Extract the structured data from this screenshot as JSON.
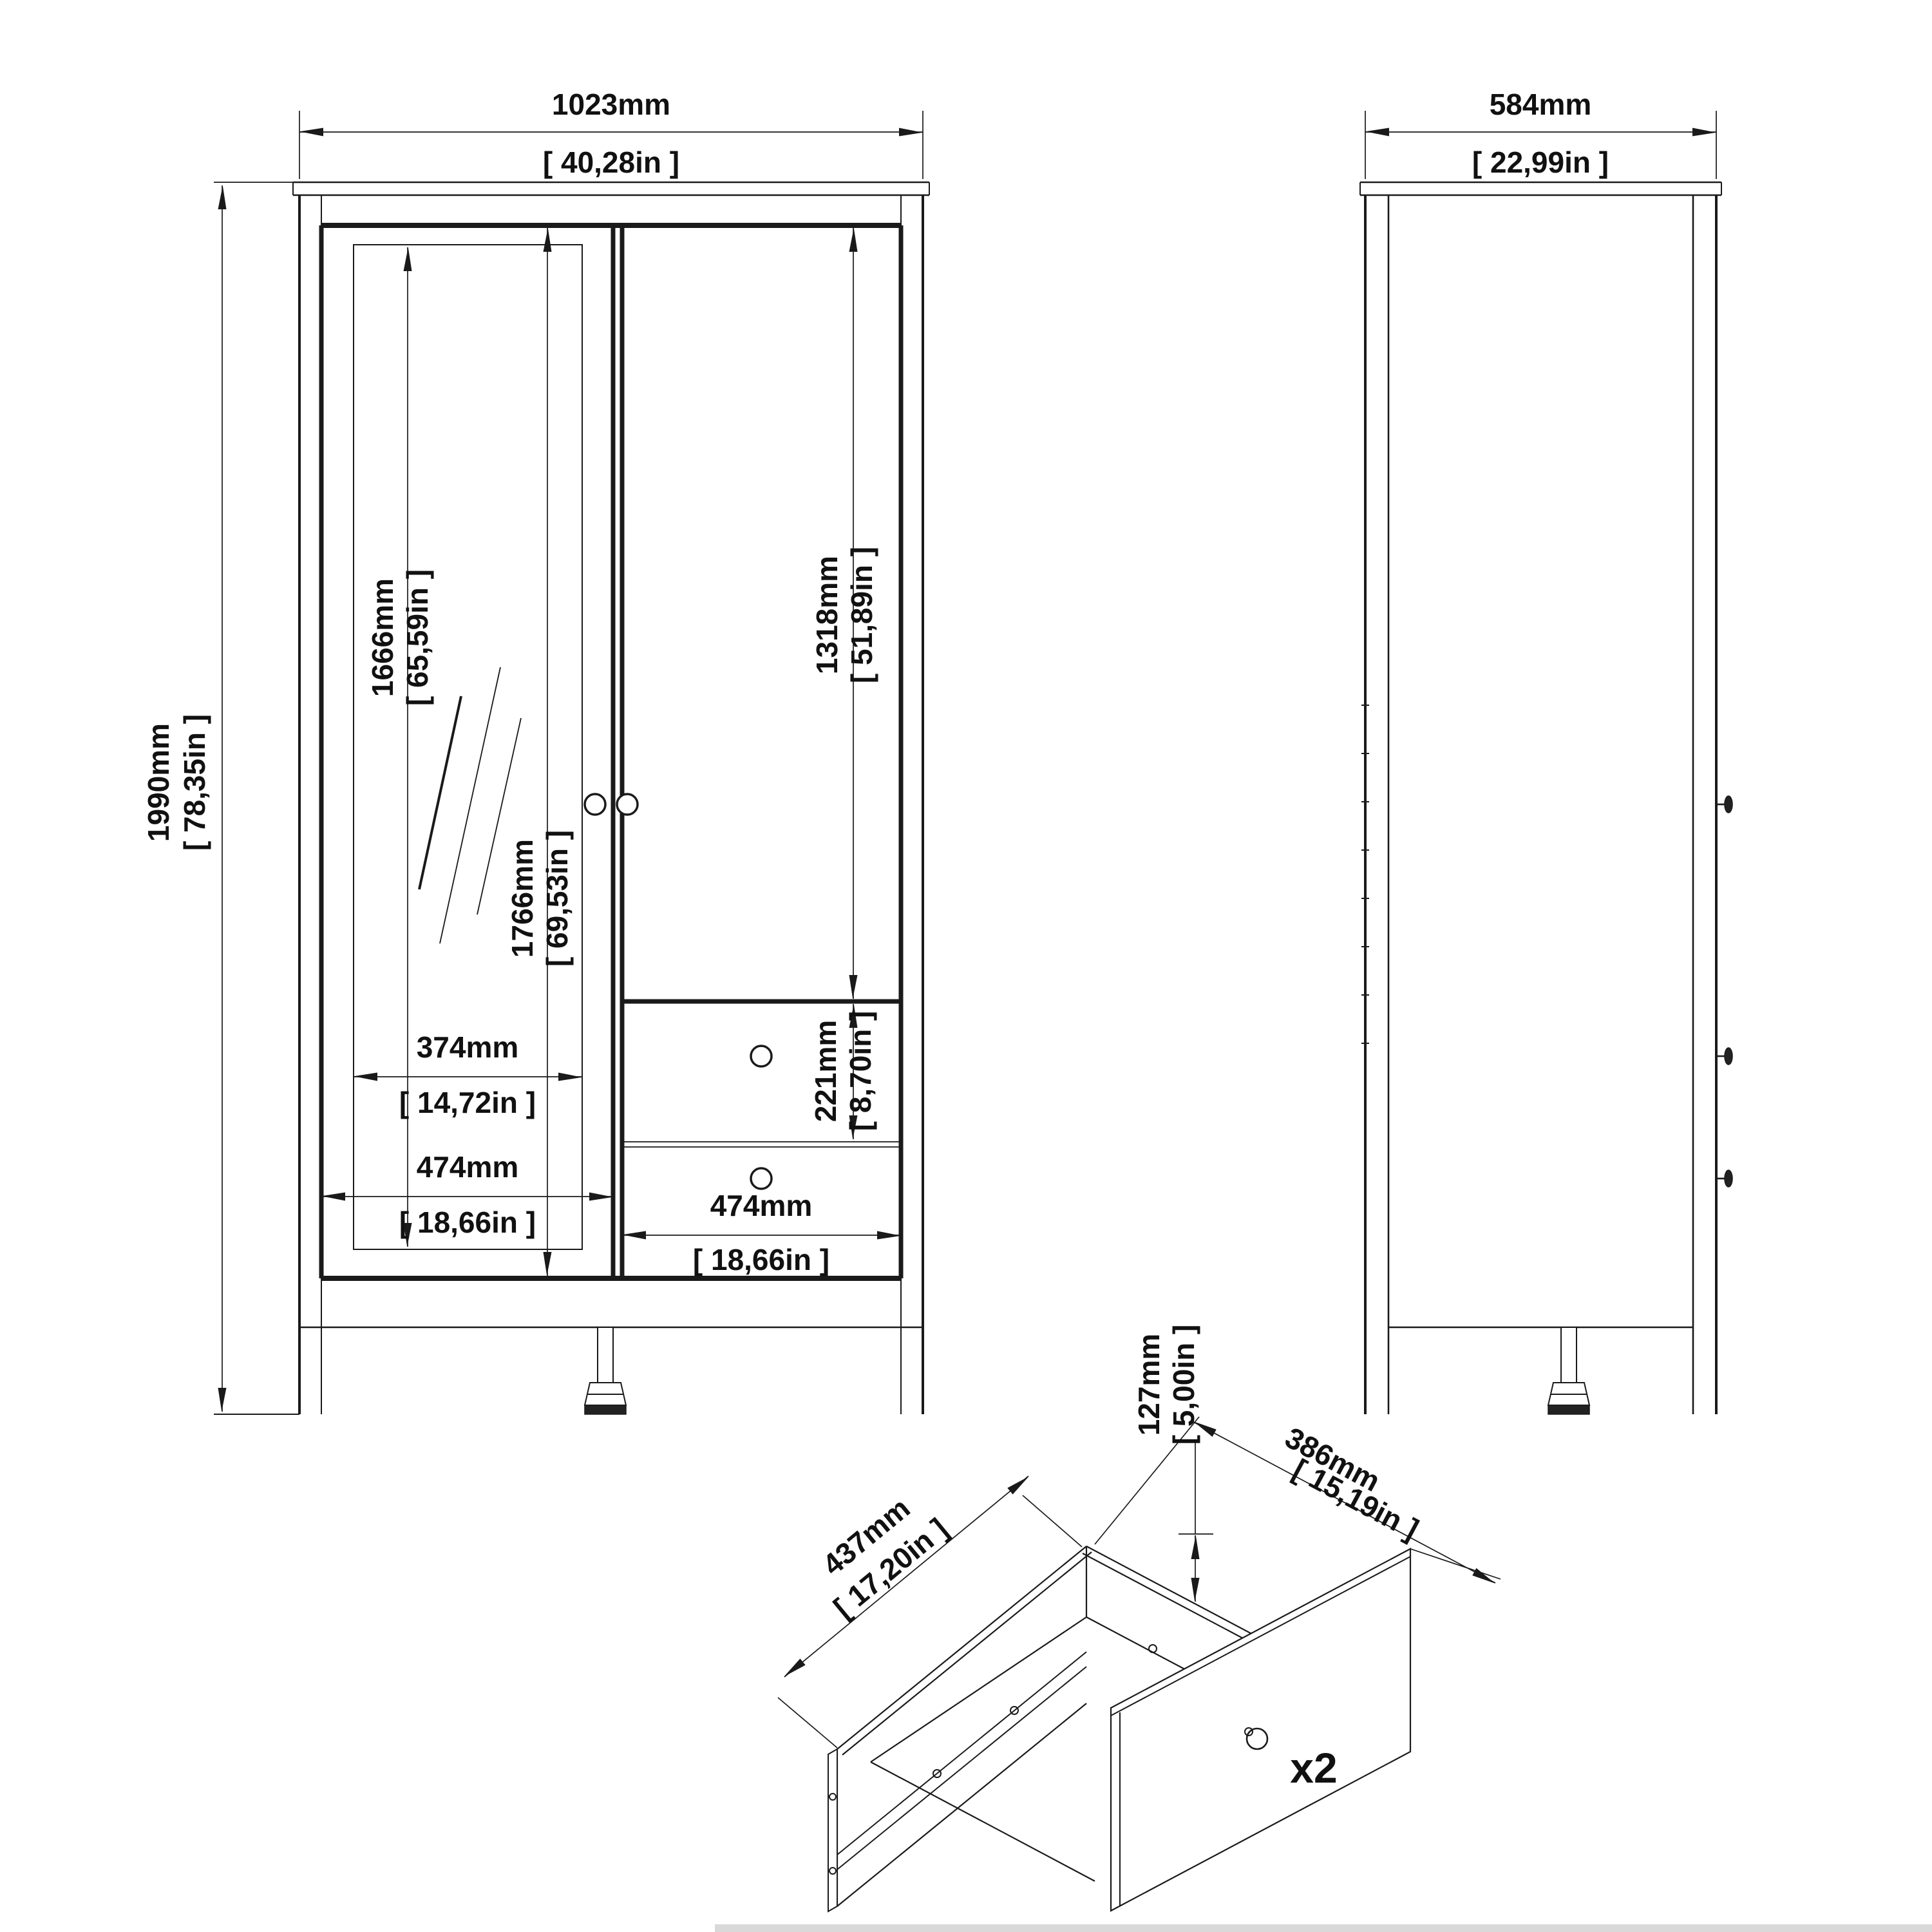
{
  "front_view": {
    "width": {
      "mm": "1023mm",
      "in": "[ 40,28in ]"
    },
    "height": {
      "mm": "1990mm",
      "in": "[ 78,35in ]"
    },
    "mirror_height": {
      "mm": "1666mm",
      "in": "[ 65,59in ]"
    },
    "door_height": {
      "mm": "1766mm",
      "in": "[ 69,53in ]"
    },
    "right_door_height": {
      "mm": "1318mm",
      "in": "[ 51,89in ]"
    },
    "drawer_height": {
      "mm": "221mm",
      "in": "[ 8,70in ]"
    },
    "mirror_width": {
      "mm": "374mm",
      "in": "[ 14,72in ]"
    },
    "left_door_width": {
      "mm": "474mm",
      "in": "[ 18,66in ]"
    },
    "drawer_width": {
      "mm": "474mm",
      "in": "[ 18,66in ]"
    }
  },
  "side_view": {
    "depth": {
      "mm": "584mm",
      "in": "[ 22,99in ]"
    }
  },
  "drawer_detail": {
    "depth": {
      "mm": "437mm",
      "in": "[ 17,20in ]"
    },
    "width": {
      "mm": "386mm",
      "in": "[ 15,19in ]"
    },
    "front_height": {
      "mm": "127mm",
      "in": "[ 5,00in ]"
    },
    "quantity": "x2"
  }
}
